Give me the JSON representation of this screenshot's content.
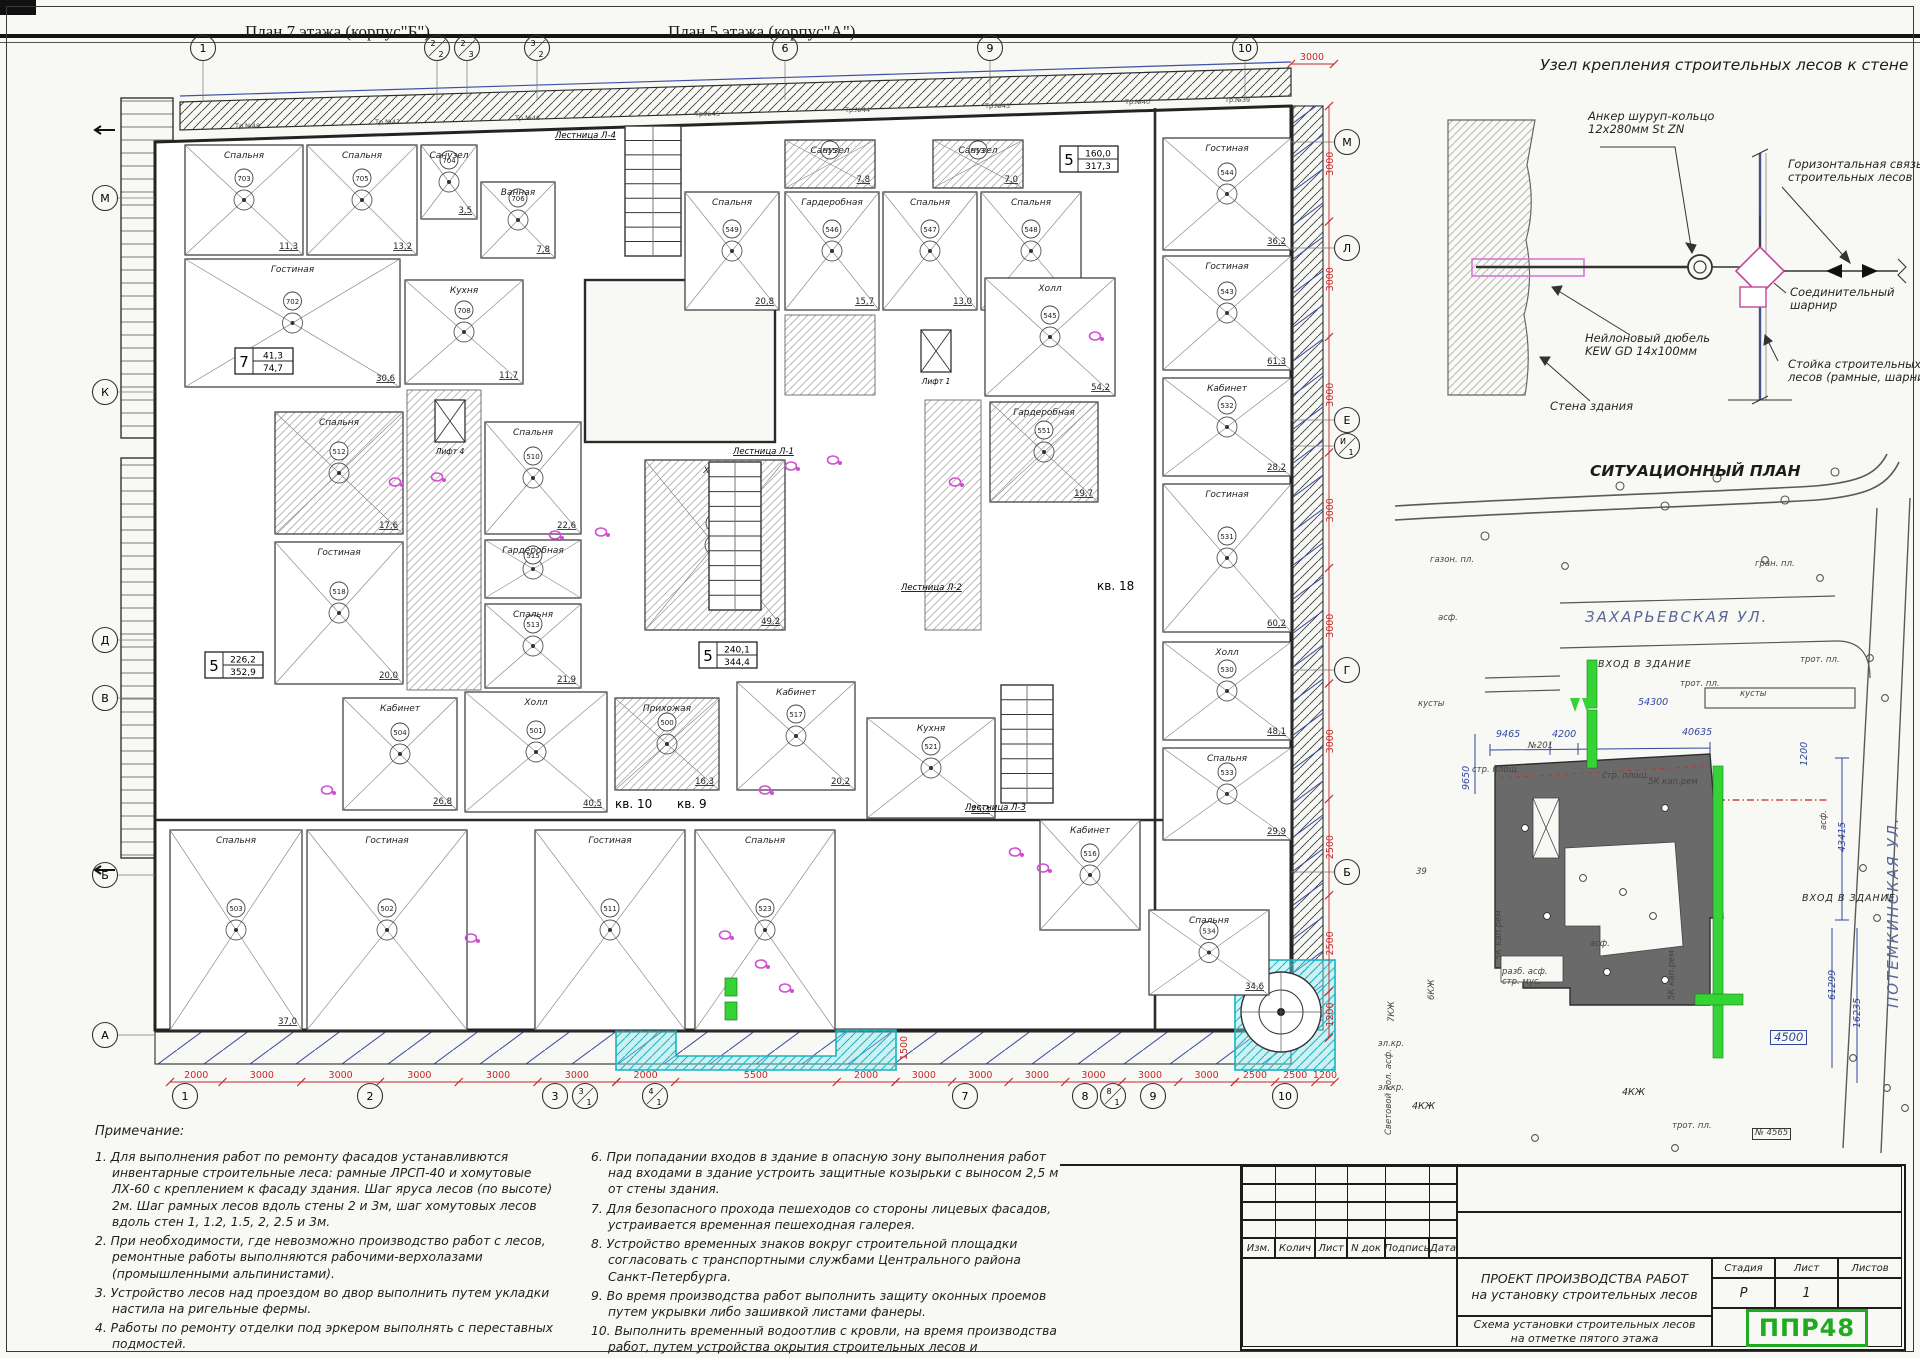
{
  "plans": {
    "title_left": "План 7 этажа (корпус\"Б\")",
    "title_right": "План 5 этажа (корпус\"А\")"
  },
  "floorplan": {
    "axes_top": [
      "1",
      "2/2",
      "2/3",
      "3/2",
      "6",
      "9",
      "10"
    ],
    "axes_bottom": [
      "1",
      "2",
      "3",
      "3/1",
      "4/1",
      "7",
      "8",
      "8/1",
      "9",
      "10"
    ],
    "axes_left": [
      "М",
      "К",
      "Д",
      "В",
      "Б",
      "А"
    ],
    "axes_right": [
      "М",
      "Л",
      "Е",
      "И/1",
      "Г",
      "Б"
    ],
    "dims_bottom": [
      [
        "2000",
        "3000",
        "3000",
        "3000",
        "3000",
        "3000"
      ],
      [
        "2000",
        "5500",
        "2000"
      ],
      [
        "3000",
        "3000",
        "3000",
        "3000",
        "3000",
        "3000"
      ],
      [
        "2500",
        "2500",
        "1200"
      ]
    ],
    "dims_right": [
      "3000",
      "3000",
      "3000",
      "3000",
      "3000",
      "3000",
      "2500",
      "2500",
      "1200"
    ],
    "dim_top_right": "3000",
    "recess_depth": "1500",
    "stair_labels": [
      "Лестница Л-4",
      "Лестница Л-1",
      "Лестница Л-3",
      "Лестница Л-2"
    ],
    "lift_labels": [
      "Лифт 4",
      "Лифт 1"
    ],
    "apt_labels": [
      "кв. 10",
      "кв. 9",
      "кв. 18"
    ],
    "pipe_labels": [
      "Тр.№48",
      "Тр.№47",
      "Тр.№46",
      "Тр.№45",
      "Тр.№44",
      "Тр.№43",
      "Тр.№40",
      "Тр.№39"
    ],
    "stamps": [
      {
        "rooms": "7",
        "top": "41,3",
        "bottom": "74,7"
      },
      {
        "rooms": "5",
        "top": "226,2",
        "bottom": "352,9"
      },
      {
        "rooms": "5",
        "top": "240,1",
        "bottom": "344,4"
      },
      {
        "rooms": "5",
        "top": "160,0",
        "bottom": "317,3"
      }
    ],
    "rooms": [
      {
        "name": "Спальня",
        "area": "11,3",
        "num": "703"
      },
      {
        "name": "Спальня",
        "area": "13,2",
        "num": "705"
      },
      {
        "name": "Санузел",
        "area": "3,5",
        "num": "704"
      },
      {
        "name": "Ванная",
        "area": "7,8",
        "num": "706"
      },
      {
        "name": "Гостиная",
        "area": "30,6",
        "num": "702"
      },
      {
        "name": "Кухня",
        "area": "11,7",
        "num": "708"
      },
      {
        "name": "Спальня",
        "area": "20,8",
        "num": "549"
      },
      {
        "name": "Гардеробная",
        "area": "15,7",
        "num": "546"
      },
      {
        "name": "Спальня",
        "area": "13,0",
        "num": "547"
      },
      {
        "name": "Спальня",
        "area": "18,6",
        "num": "548"
      },
      {
        "name": "Санузел",
        "area": "7,8",
        "num": "555"
      },
      {
        "name": "Санузел",
        "area": "7,0",
        "num": "553"
      },
      {
        "name": "Гостиная",
        "area": "36,2",
        "num": "544"
      },
      {
        "name": "Гостиная",
        "area": "61,3",
        "num": "543"
      },
      {
        "name": "Холл",
        "area": "54,2",
        "num": "545"
      },
      {
        "name": "Гардеробная",
        "area": "19,7",
        "num": "551"
      },
      {
        "name": "Кабинет",
        "area": "28,2",
        "num": "532"
      },
      {
        "name": "Гостиная",
        "area": "60,2",
        "num": "531"
      },
      {
        "name": "Холл",
        "area": "48,1",
        "num": "530"
      },
      {
        "name": "Спальня",
        "area": "29,9",
        "num": "533"
      },
      {
        "name": "Спальня",
        "area": "34,6",
        "num": "534"
      },
      {
        "name": "Спальня",
        "area": "22,6",
        "num": "510"
      },
      {
        "name": "Гардеробная",
        "area": "",
        "num": "515"
      },
      {
        "name": "Спальня",
        "area": "21,9",
        "num": "513"
      },
      {
        "name": "Спальня",
        "area": "17,6",
        "num": "512"
      },
      {
        "name": "Гостиная",
        "area": "20,0",
        "num": "518"
      },
      {
        "name": "Кабинет",
        "area": "26,8",
        "num": "504"
      },
      {
        "name": "Холл",
        "area": "40,5",
        "num": "501"
      },
      {
        "name": "Прихожая",
        "area": "16,3",
        "num": "500"
      },
      {
        "name": "Кабинет",
        "area": "20,2",
        "num": "517"
      },
      {
        "name": "Кухня",
        "area": "25,3",
        "num": "521"
      },
      {
        "name": "Холл",
        "area": "49,2",
        "num": "520"
      },
      {
        "name": "Спальня",
        "area": "37,0",
        "num": "503"
      },
      {
        "name": "Гостиная",
        "area": "",
        "num": "502"
      },
      {
        "name": "Гостиная",
        "area": "",
        "num": "511"
      },
      {
        "name": "Спальня",
        "area": "",
        "num": "523"
      },
      {
        "name": "Кабинет",
        "area": "",
        "num": "516"
      }
    ]
  },
  "detail": {
    "title": "Узел крепления строительных лесов к стене",
    "labels": {
      "anchor1": "Анкер шуруп-кольцо",
      "anchor2": "12х280мм St ZN",
      "horiz1": "Горизонтальная связь",
      "horiz2": "строительных лесов",
      "hinge1": "Соединительный",
      "hinge2": "шарнир",
      "dowel1": "Нейлоновый дюбель",
      "dowel2": "KEW GD 14х100мм",
      "wall": "Стена здания",
      "post1": "Стойка строительных",
      "post2": "лесов (рамные, шарнирные)"
    }
  },
  "sitplan": {
    "title": "СИТУАЦИОННЫЙ ПЛАН",
    "street_top": "ЗАХАРЬЕВСКАЯ УЛ.",
    "street_right": "ПОТЕМКИНСКАЯ УЛ.",
    "dims": {
      "d54300": "54300",
      "d9465": "9465",
      "d4200": "4200",
      "d40635": "40635",
      "d9650": "9650",
      "d43415": "43415",
      "d61299": "61299",
      "d16235": "16235",
      "d4500": "4500",
      "d1200": "1200"
    },
    "labels": {
      "entrance": "ВХОД В ЗДАНИЕ",
      "kaprem1": "5К",
      "kaprem2": "кап.рем",
      "bld6": "6КЖ",
      "bld7": "7КЖ",
      "bld4": "4КЖ",
      "n39": "39",
      "n201": "№201",
      "n4565": "№ 4565",
      "trot": "трот. пл.",
      "strpl": "стр. площ.",
      "kusty": "кусты",
      "asf": "асф.",
      "gran": "гран. пл.",
      "gazon": "газон. пл.",
      "svet1": "Световой кол.",
      "svet2": "асф.",
      "razb1": "разб. асф.",
      "razb2": "стр. мус.",
      "elkr": "эл.кр."
    }
  },
  "notes": {
    "heading": "Примечание:",
    "col1": [
      {
        "n": "1.",
        "t": "Для выполнения работ по ремонту фасадов устанавливются инвентарные строительные леса: рамные ЛРСП-40 и хомутовые ЛХ-60 с креплением к фасаду здания. Шаг яруса лесов (по высоте) 2м. Шаг рамных лесов вдоль стены 2 и 3м, шаг хомутовых лесов вдоль стен 1, 1.2, 1.5, 2, 2.5 и 3м."
      },
      {
        "n": "2.",
        "t": "При необходимости, где невозможно производство работ с лесов, ремонтные работы выполняются рабочими-верхолазами (промышленными альпинистами)."
      },
      {
        "n": "3.",
        "t": "Устройство лесов над проездом во двор выполнить путем укладки настила на ригельные фермы."
      },
      {
        "n": "4.",
        "t": "Работы по ремонту отделки под эркером выполнять с переставных подмостей."
      },
      {
        "n": "5.",
        "t": "Опасную зону работы оградить леерным ограждением - сигнальной лентой красного или желтого цвета."
      }
    ],
    "col2": [
      {
        "n": "6.",
        "t": "При попадании входов в здание в опасную зону выполнения работ над входами в здание устроить защитные козырьки с выносом 2,5 м от стены здания."
      },
      {
        "n": "7.",
        "t": "Для безопасного прохода пешеходов со стороны лицевых фасадов, устраивается временная пешеходная галерея."
      },
      {
        "n": "8.",
        "t": "Устройство временных знаков вокруг строительной площадки согласовать с транспортными службами Центрального района Санкт-Петербурга."
      },
      {
        "n": "9.",
        "t": "Во время производства работ выполнить защиту оконных проемов путем укрывки либо зашивкой листами фанеры."
      },
      {
        "n": "10.",
        "t": "Выполнить временный водоотлив с кровли, на время производства работ, путем устройства окрытия строительных лесов и организованного отвода на них атмосферных осадков."
      }
    ]
  },
  "titleblock": {
    "rev": [
      "Изм.",
      "Колич",
      "Лист",
      "N док",
      "Подпись",
      "Дата"
    ],
    "doc1": "ПРОЕКТ ПРОИЗВОДСТВА РАБОТ",
    "doc2": "на установку строительных лесов",
    "stage_h": "Стадия",
    "sheet_h": "Лист",
    "sheets_h": "Листов",
    "stage": "Р",
    "sheet": "1",
    "sheets": "",
    "sub1": "Схема установки строительных лесов",
    "sub2": "на отметке пятого этажа",
    "logo": "ППР48"
  }
}
